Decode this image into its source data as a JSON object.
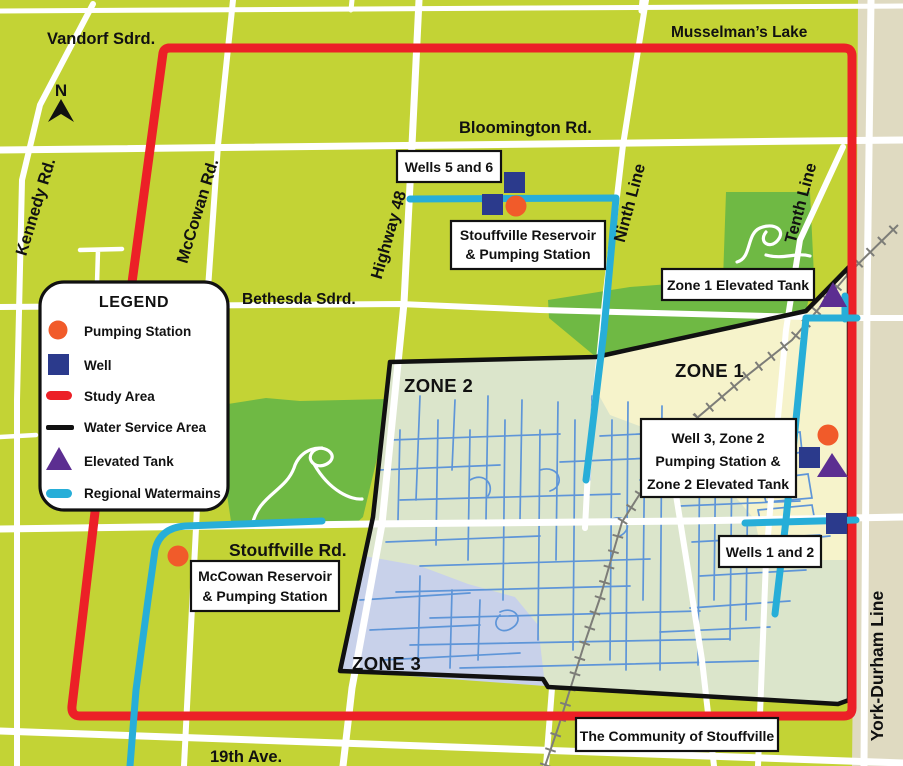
{
  "compass": {
    "label": "N"
  },
  "roads": {
    "vandorf": "Vandorf Sdrd.",
    "musselmans": "Musselman’s Lake",
    "bloomington": "Bloomington Rd.",
    "bethesda": "Bethesda Sdrd.",
    "stouffville_rd": "Stouffville Rd.",
    "nineteenth": "19th Ave.",
    "kennedy": "Kennedy Rd.",
    "mccowan": "McCowan Rd.",
    "highway48": "Highway 48",
    "ninth": "Ninth Line",
    "tenth": "Tenth Line",
    "york_durham": "York-Durham Line"
  },
  "zones": {
    "zone1": "ZONE 1",
    "zone2": "ZONE 2",
    "zone3": "ZONE 3"
  },
  "callouts": {
    "wells56": {
      "line1": "Wells 5 and 6"
    },
    "stouffville_reservoir": {
      "line1": "Stouffville Reservoir",
      "line2": "& Pumping Station"
    },
    "zone1_tank": {
      "line1": "Zone 1 Elevated Tank"
    },
    "well3_group": {
      "line1": "Well 3, Zone 2",
      "line2": "Pumping Station &",
      "line3": "Zone 2 Elevated Tank"
    },
    "wells12": {
      "line1": "Wells 1 and 2"
    },
    "mccowan_reservoir": {
      "line1": "McCowan Reservoir",
      "line2": "& Pumping Station"
    },
    "community": {
      "line1": "The Community of Stouffville"
    }
  },
  "legend": {
    "title": "LEGEND",
    "items": [
      {
        "label": "Pumping Station",
        "symbol": "pumping-station"
      },
      {
        "label": "Well",
        "symbol": "well"
      },
      {
        "label": "Study Area",
        "symbol": "study-area"
      },
      {
        "label": "Water Service Area",
        "symbol": "water-service-area"
      },
      {
        "label": "Elevated Tank",
        "symbol": "elevated-tank"
      },
      {
        "label": "Regional Watermains",
        "symbol": "regional-watermains"
      }
    ]
  },
  "colors": {
    "background": "#c3d335",
    "park": "#6fb944",
    "boundary_strip": "#dfdac1",
    "zone1_fill": "#f6f3cb",
    "zone2_fill": "#dbe5cb",
    "zone3_fill": "#c8d1ea",
    "study_area": "#ec2027",
    "water_service_area": "#111111",
    "regional_watermain": "#27aed8",
    "pumping_station": "#f15b2a",
    "well": "#2b3a8c",
    "elevated_tank": "#5c2e91",
    "street": "#5e95d8",
    "railway": "#7d7d78",
    "road": "#ffffff"
  }
}
